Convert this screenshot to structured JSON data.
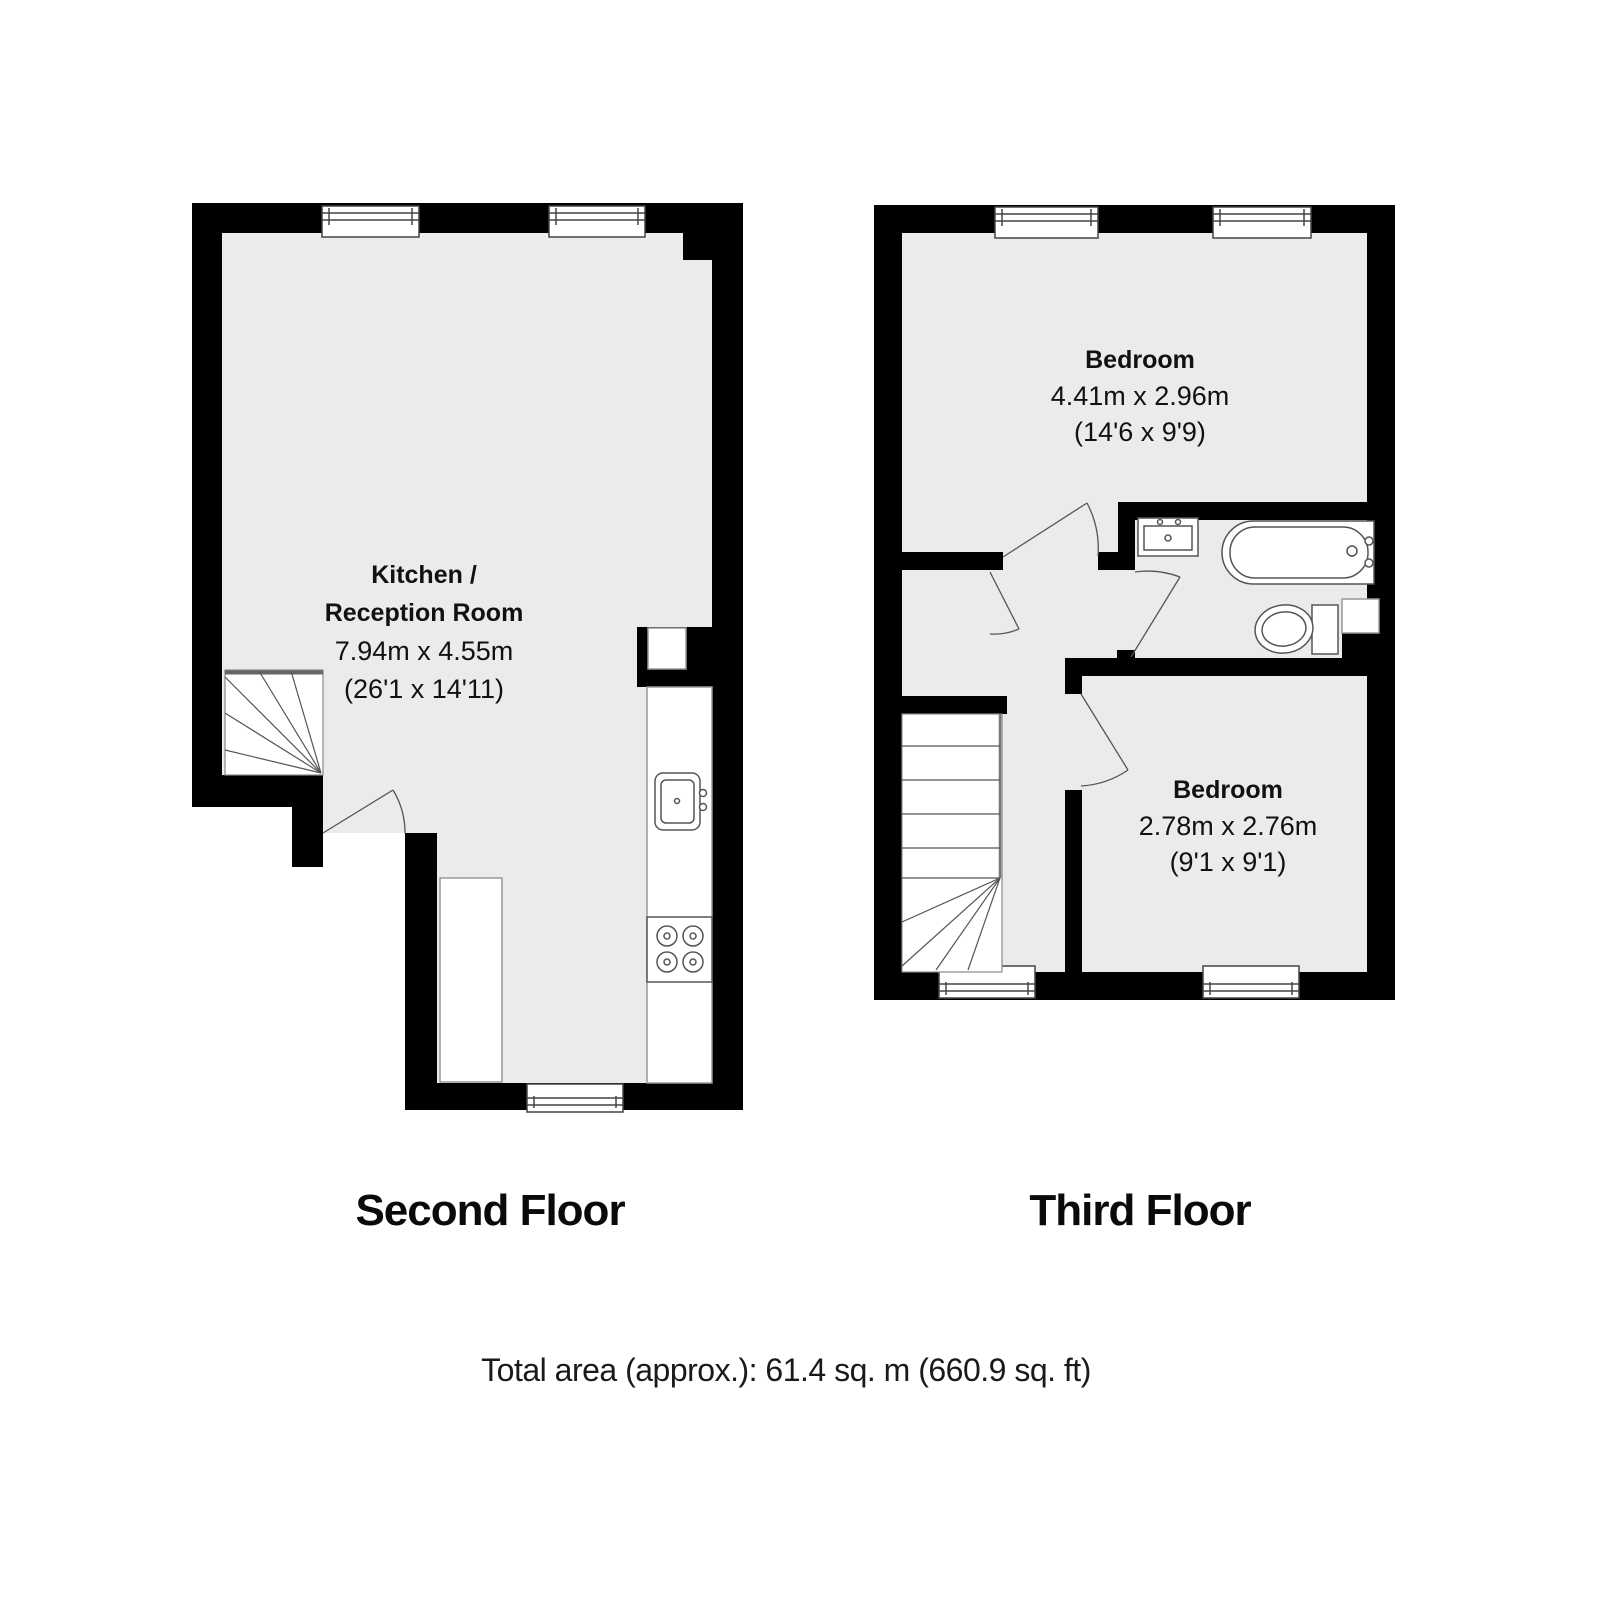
{
  "second_floor": {
    "title": "Second Floor",
    "room": {
      "name_line1": "Kitchen /",
      "name_line2": "Reception Room",
      "dims_metric": "7.94m x 4.55m",
      "dims_imperial": "(26'1 x 14'11)"
    }
  },
  "third_floor": {
    "title": "Third Floor",
    "bedroom_large": {
      "name": "Bedroom",
      "dims_metric": "4.41m x 2.96m",
      "dims_imperial": "(14'6 x 9'9)"
    },
    "bedroom_small": {
      "name": "Bedroom",
      "dims_metric": "2.78m x 2.76m",
      "dims_imperial": "(9'1 x 9'1)"
    }
  },
  "footer": {
    "total_area": "Total area (approx.): 61.4 sq. m (660.9 sq. ft)"
  },
  "colors": {
    "wall": "#000000",
    "floor": "#ebebeb",
    "fixture_line": "#555555",
    "text": "#111111"
  }
}
